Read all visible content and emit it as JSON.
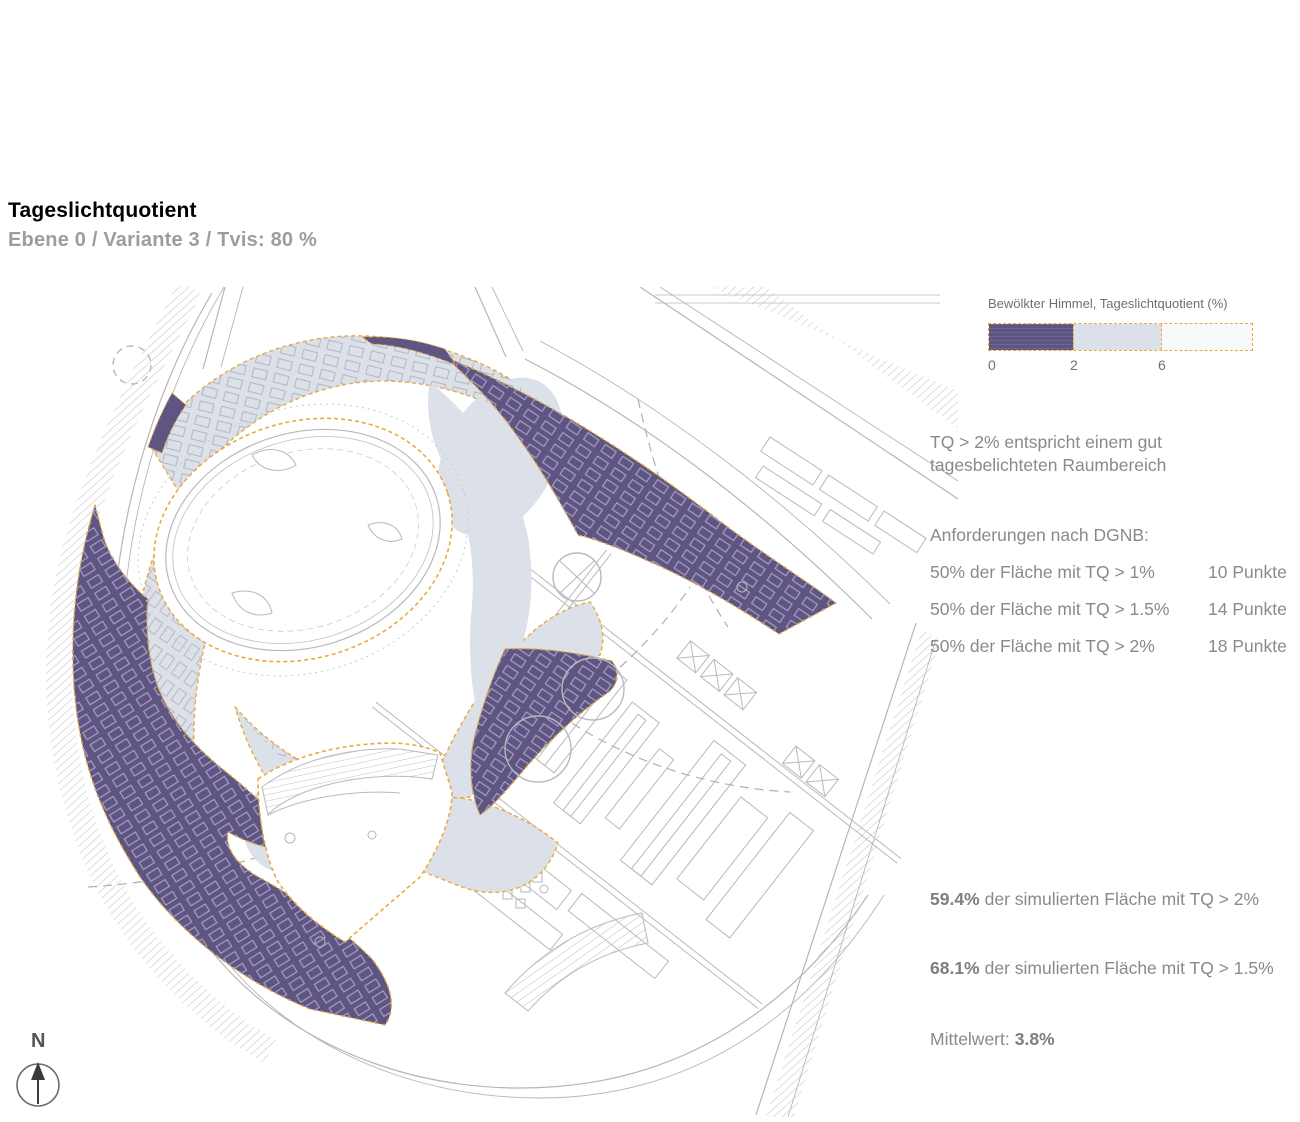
{
  "header": {
    "title": "Tageslichtquotient",
    "subtitle": "Ebene 0 / Variante 3 / Tvis: 80 %"
  },
  "legend": {
    "title": "Bewölkter Himmel, Tageslichtquotient (%)",
    "ticks": {
      "t0": "0",
      "t2": "2",
      "t6": "6"
    },
    "segments": [
      {
        "range": "0-2",
        "color": "#5e5583"
      },
      {
        "range": "2-6",
        "color": "#dce1e9"
      },
      {
        "range": ">6",
        "color": "#f8f9fb"
      }
    ],
    "boundary_color": "#eaa93d"
  },
  "notes": {
    "line1": "TQ > 2% entspricht einem gut",
    "line2": "tagesbelichteten Raumbereich"
  },
  "dgnb": {
    "heading": "Anforderungen nach DGNB:",
    "rows": [
      {
        "requirement": "50% der Fläche mit TQ > 1%",
        "points": "10 Punkte"
      },
      {
        "requirement": "50% der Fläche mit TQ > 1.5%",
        "points": "14 Punkte"
      },
      {
        "requirement": "50% der Fläche mit TQ > 2%",
        "points": "18 Punkte"
      }
    ]
  },
  "results": {
    "r1": {
      "value": "59.4%",
      "text": "der simulierten Fläche mit TQ > 2%"
    },
    "r2": {
      "value": "68.1%",
      "text": "der simulierten Fläche mit TQ > 1.5%"
    },
    "mittelwert_label": "Mittelwert:",
    "mittelwert_value": "3.8%"
  },
  "compass": {
    "label": "N"
  },
  "map": {
    "type": "daylight-factor-site-plan",
    "colors": {
      "tq_0_2_purple": "#5e5582",
      "tq_2_6_blue": "#dce1e9",
      "tq_above_6_white": "#ffffff",
      "site_boundary_orange": "#eaa93d",
      "plan_linework_gray": "#b9b9bd",
      "units_over_purple": "#a79ec6"
    }
  }
}
